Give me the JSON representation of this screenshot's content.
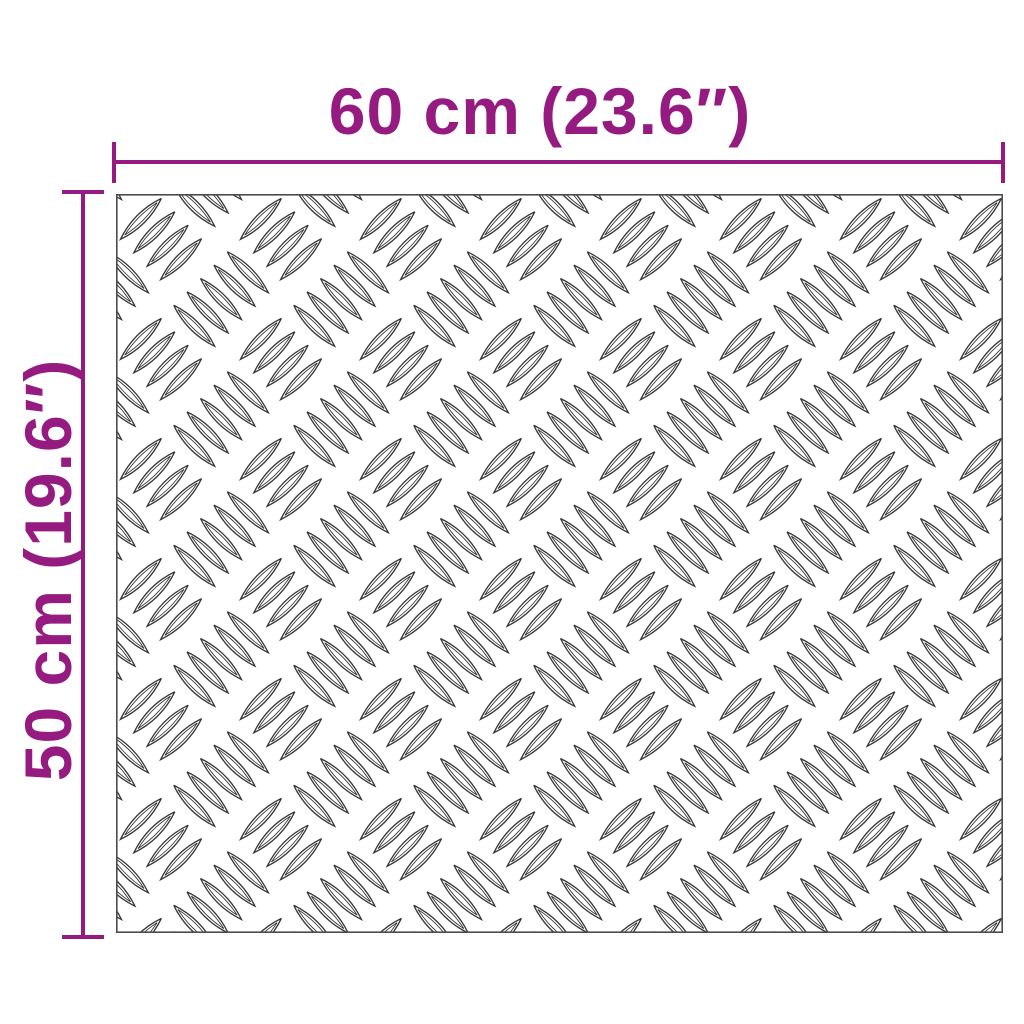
{
  "diagram": {
    "width_label": "60 cm (23.6″)",
    "height_label": "50 cm (19.6″)",
    "accent_color": "#951b81",
    "plate_line_color": "#3a3a3a",
    "plate_border_color": "#4b4b4b",
    "plate_background": "#ffffff",
    "pattern_name": "aluminium-checker-plate"
  }
}
